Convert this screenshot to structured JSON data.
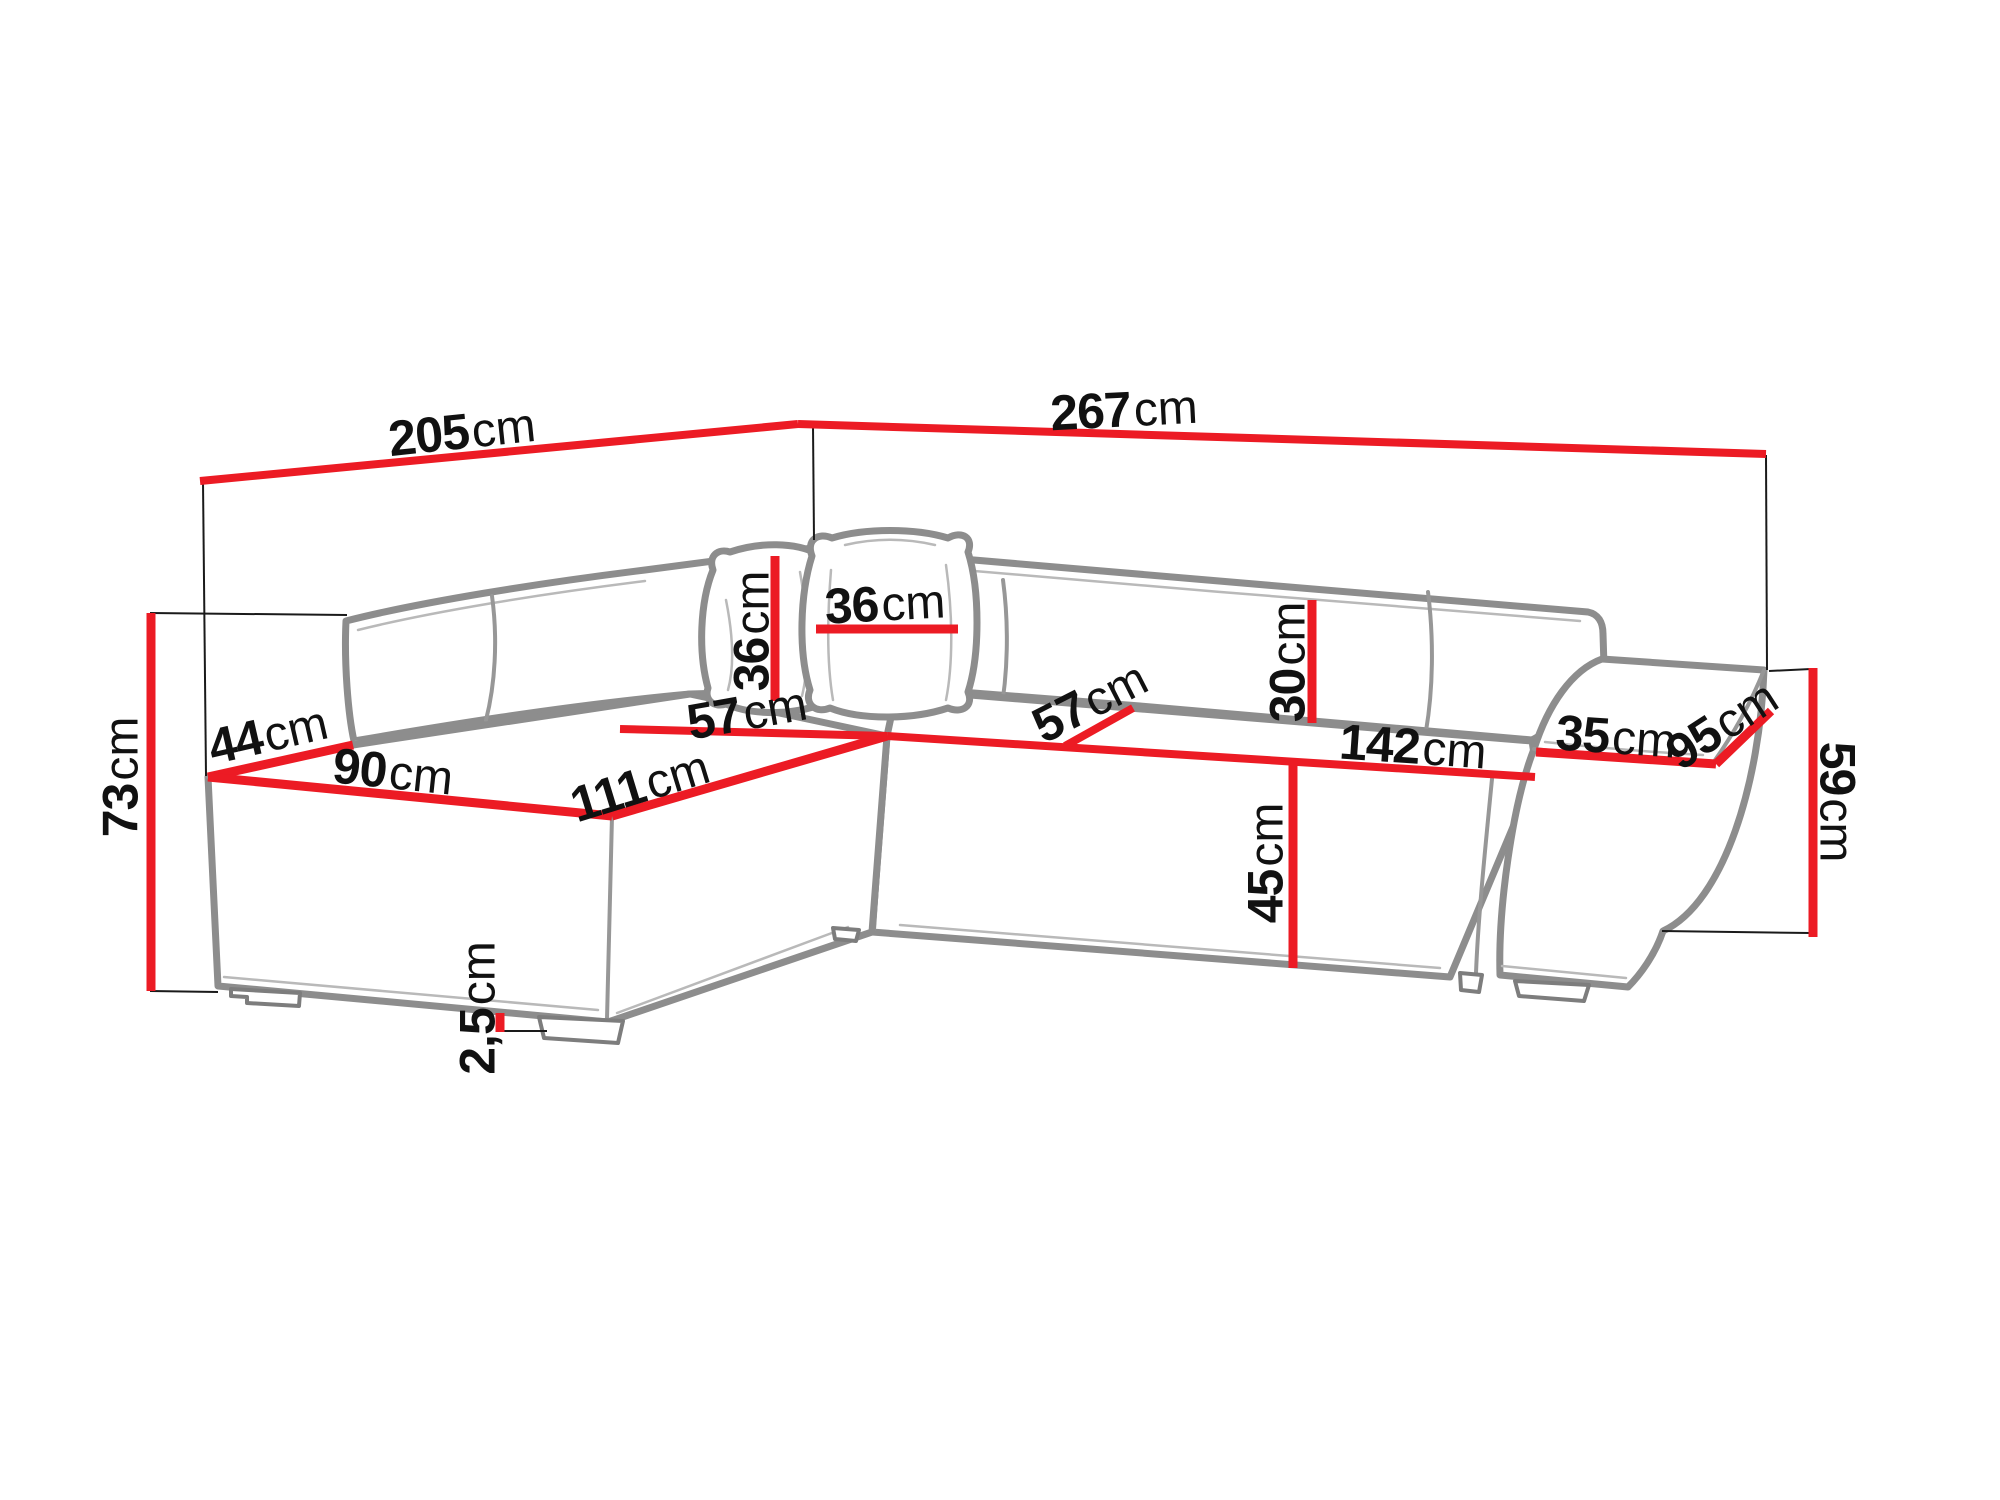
{
  "diagram": {
    "type": "furniture-dimension-diagram",
    "subject": "corner sofa with chaise and pouf armrest",
    "unit": "cm",
    "colors": {
      "dimension_line": "#ec1b24",
      "sofa_outline": "#8d8d8d",
      "label_text": "#111111",
      "projection_line": "#1a1a1a",
      "background": "#ffffff"
    },
    "dimensions": [
      {
        "name": "back-width-left",
        "value": "205",
        "unit": "cm"
      },
      {
        "name": "back-width-right",
        "value": "267",
        "unit": "cm"
      },
      {
        "name": "total-height",
        "value": "73",
        "unit": "cm"
      },
      {
        "name": "armrest-top-width",
        "value": "44",
        "unit": "cm"
      },
      {
        "name": "chaise-front-width",
        "value": "90",
        "unit": "cm"
      },
      {
        "name": "chaise-seat-length",
        "value": "111",
        "unit": "cm"
      },
      {
        "name": "seat-depth-left",
        "value": "57",
        "unit": "cm"
      },
      {
        "name": "pillow-height",
        "value": "36",
        "unit": "cm"
      },
      {
        "name": "pillow-width",
        "value": "36",
        "unit": "cm"
      },
      {
        "name": "seat-depth-right",
        "value": "57",
        "unit": "cm"
      },
      {
        "name": "backrest-cushion-height",
        "value": "30",
        "unit": "cm"
      },
      {
        "name": "seat-front-width-right",
        "value": "142",
        "unit": "cm"
      },
      {
        "name": "seat-height",
        "value": "45",
        "unit": "cm"
      },
      {
        "name": "pouf-top-width",
        "value": "35",
        "unit": "cm"
      },
      {
        "name": "pouf-depth",
        "value": "95",
        "unit": "cm"
      },
      {
        "name": "pouf-height",
        "value": "59",
        "unit": "cm"
      },
      {
        "name": "leg-height",
        "value": "2,5",
        "unit": "cm"
      }
    ]
  }
}
